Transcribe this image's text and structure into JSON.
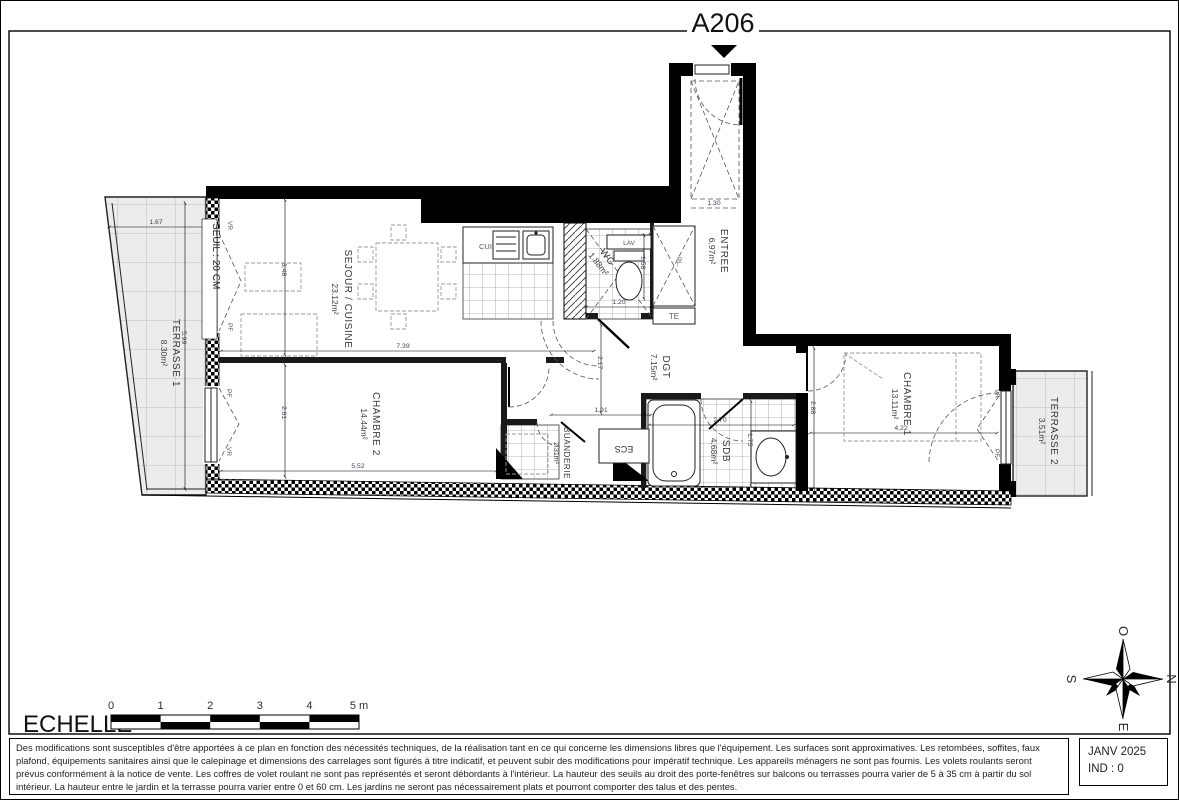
{
  "title": "A206",
  "rooms": {
    "sejour": {
      "name": "SEJOUR / CUISINE",
      "area": "23.12m²"
    },
    "terrasse1": {
      "name": "TERRASSE 1",
      "area": "8.30m²"
    },
    "terrasse2": {
      "name": "TERRASSE 2",
      "area": "3.51m²"
    },
    "chambre1": {
      "name": "CHAMBRE 1",
      "area": "13.11m²"
    },
    "chambre2": {
      "name": "CHAMBRE 2",
      "area": "14.44m²"
    },
    "entree": {
      "name": "ENTREE",
      "area": "6.97m²"
    },
    "wc": {
      "name": "WC",
      "area": "1.88m²"
    },
    "dgt": {
      "name": "DGT",
      "area": "7.15m²"
    },
    "sdb": {
      "name": "SDB",
      "area": "4.68m²"
    },
    "buanderie": {
      "name": "BUANDERIE",
      "area": "2.31m²"
    }
  },
  "annotations": {
    "seuil": "SEUIL : 20 CM",
    "vr": "VR",
    "pf": "PF",
    "pl": "PL.",
    "te": "TE",
    "lav": "LAV",
    "cui": "CUI",
    "ecs": "ECS"
  },
  "dimensions": {
    "sejour_w": "7.39",
    "sejour_h": "3.48",
    "chambre2_w": "5.52",
    "chambre2_h": "2.61",
    "terrasse1_w": "1.67",
    "terrasse1_l": "5.99",
    "dgt_h": "2.17",
    "dgt_w": "1.91",
    "entree_w": "1.30",
    "wc_w": "1.20",
    "wc_h": "1.58",
    "sdb_w": "2.70",
    "sdb_h": "1.75",
    "chambre1_w": "4.22",
    "chambre1_h": "2.88"
  },
  "scale_bar": {
    "label": "ECHELLE",
    "ticks": [
      "0",
      "1",
      "2",
      "3",
      "4",
      "5 m"
    ]
  },
  "compass": {
    "n": "N",
    "s": "S",
    "e": "E",
    "o": "O"
  },
  "footer": {
    "disclaimer": "Des modifications sont susceptibles d'être apportées à ce plan en fonction des nécessités techniques, de la réalisation tant en ce qui concerne les dimensions libres que l'équipement. Les surfaces sont approximatives. Les retombées, soffites, faux plafond, équipements sanitaires ainsi que le calepinage et dimensions des carrelages sont figurés à titre indicatif, et peuvent subir des modifications pour impératif technique. Les appareils ménagers ne sont pas fournis. Les volets roulants seront prévus conformément à la notice de vente. Les coffres de volet roulant ne sont pas représentés et seront débordants à l'intérieur. La hauteur des seuils au droit des porte-fenêtres sur balcons ou terrasses pourra varier de 5 à 35 cm à partir du sol intérieur. La hauteur entre le jardin et la terrasse pourra varier entre 0 et 60 cm. Les jardins ne seront pas nécessairement plats et pourront comporter des talus et des pentes.",
    "date": "JANV 2025",
    "index": "IND : 0"
  }
}
